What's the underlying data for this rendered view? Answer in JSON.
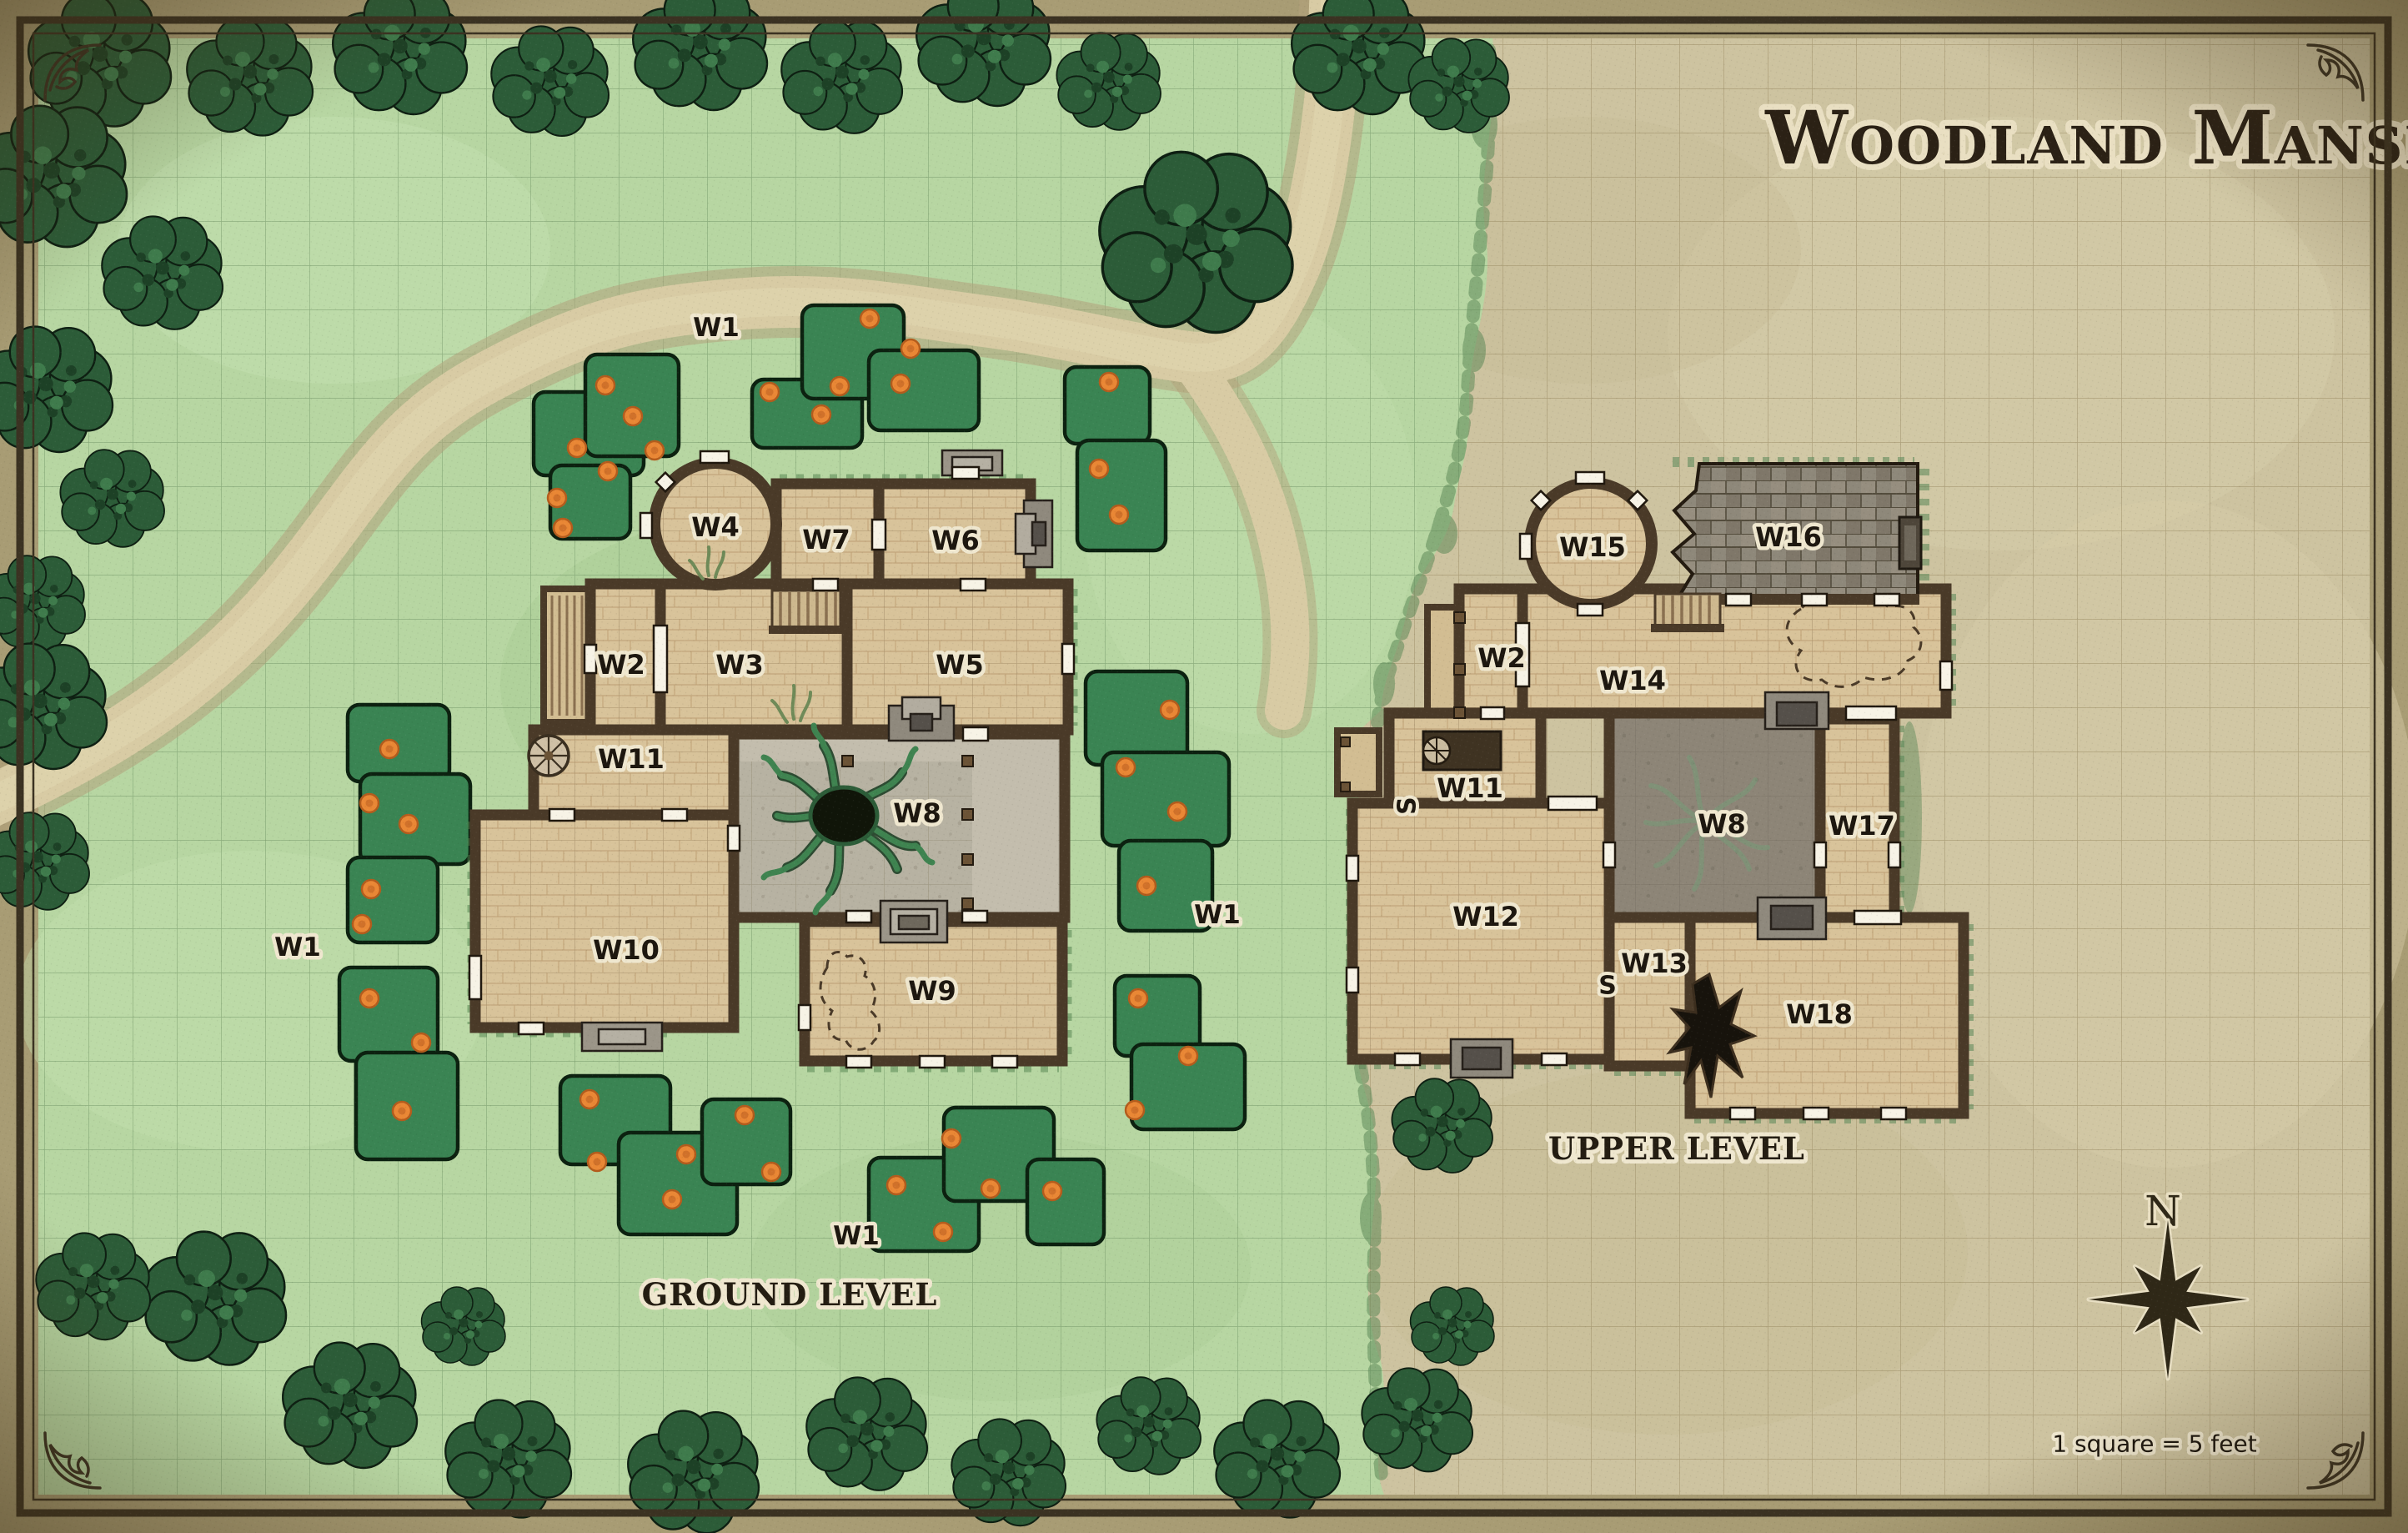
{
  "title": "Woodland Manse",
  "legend": {
    "scale_note": "1 square = 5 feet",
    "compass_north_label": "N"
  },
  "ground_level": {
    "name": "GROUND LEVEL",
    "rooms": {
      "w2": "W2",
      "w3": "W3",
      "w4": "W4",
      "w5": "W5",
      "w6": "W6",
      "w7": "W7",
      "w8": "W8",
      "w9": "W9",
      "w10": "W10",
      "w11": "W11"
    }
  },
  "upper_level": {
    "name": "UPPER LEVEL",
    "rooms": {
      "w2": "W2",
      "w8": "W8",
      "w11": "W11",
      "w12": "W12",
      "w13": "W13",
      "w14": "W14",
      "w15": "W15",
      "w16": "W16",
      "w17": "W17",
      "w18": "W18"
    },
    "stair_marker": "S"
  },
  "outdoor": {
    "woods_label": "W1"
  },
  "colors": {
    "margin": "#a89c74",
    "parchment": "#cdc3a0",
    "parchment_grid": "#8f8058",
    "grass": "#b7d6a2",
    "grass_grid": "#75976a",
    "tree_green": "#2c5c38",
    "bush_green": "#3a8453",
    "berry_orange": "#e98735",
    "wall_brown": "#4a3a28",
    "floor_wood": "#d8c39a",
    "courtyard_stone": "#b7b2a2",
    "upper_courtyard": "#8d8577",
    "roof_shingle": "#8e887a",
    "dirt_path": "#d8cba4",
    "ink": "#2b2115"
  }
}
